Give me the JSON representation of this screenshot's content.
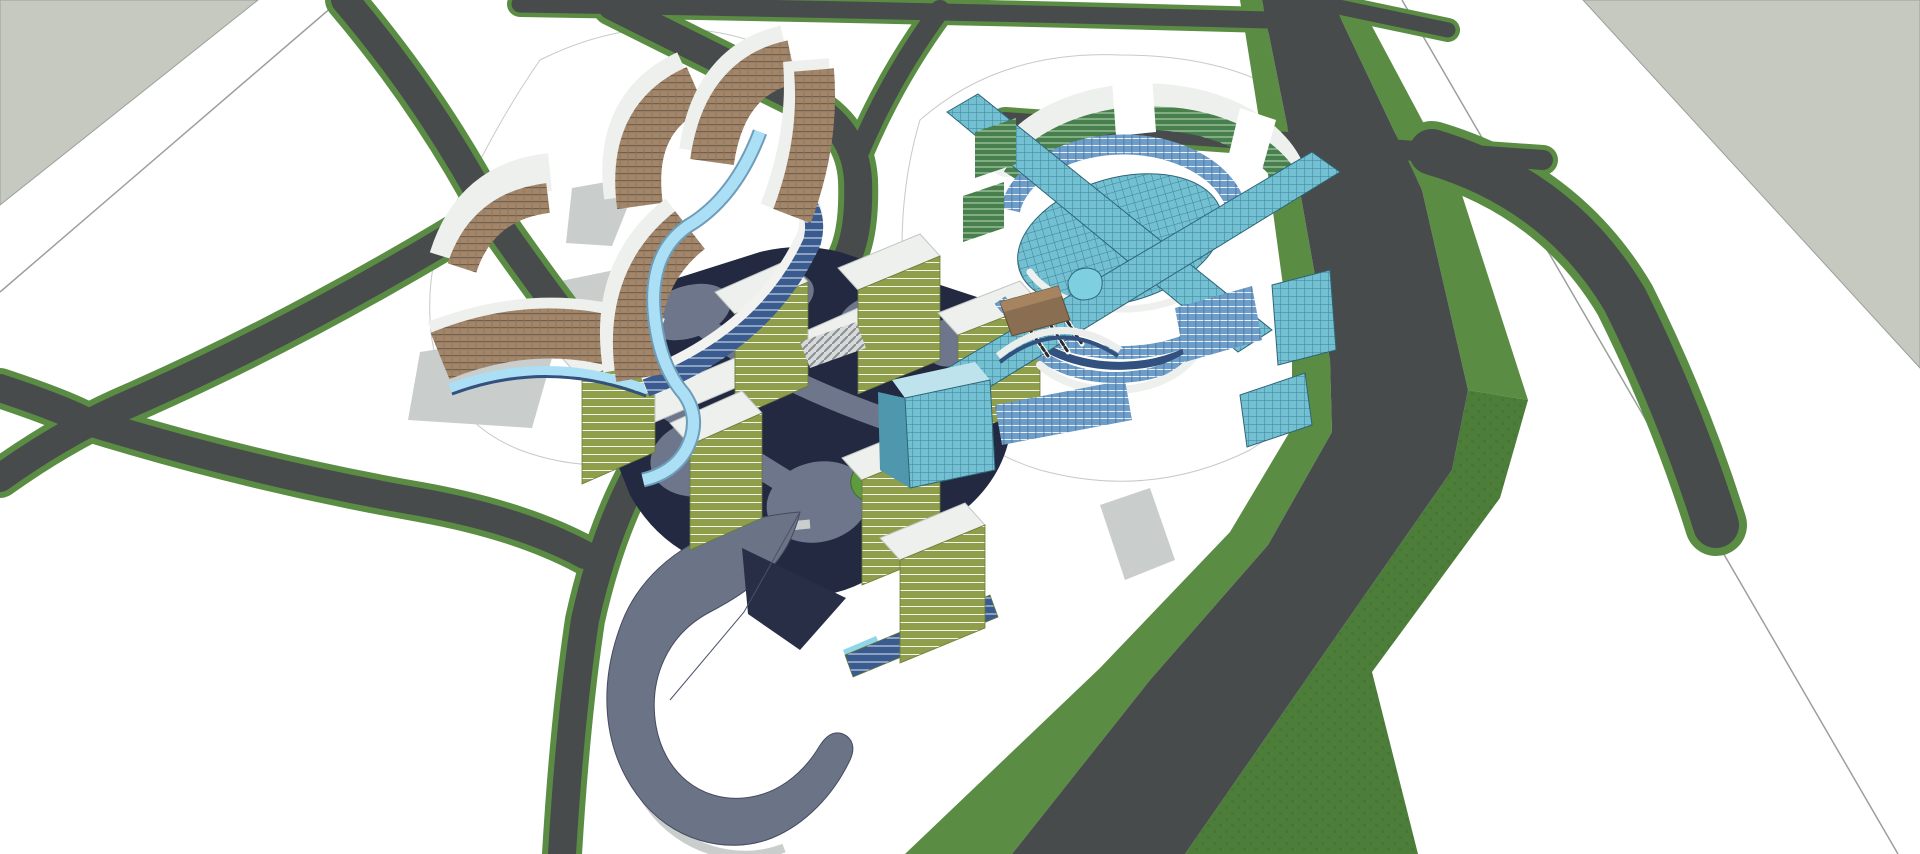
{
  "title": "3D master plan rendering",
  "palette": {
    "ground": "#ffffff",
    "offsite_plane": "#c6c9c0",
    "road_asphalt": "#474b4c",
    "road_verge_green": "#5a8c44",
    "verge_dark_textured": "#4c7d39",
    "boundary_line": "#9aa09b",
    "shadow_gray": "#c9cdcb",
    "plaza_navy": "#222940",
    "plaza_path_gray": "#6e768c",
    "plaza_stub_gray": "#9aa0ad",
    "pond_island_green": "#5e9a3e",
    "pond_rim_white": "#eceeea",
    "pond_water_cyan": "#38c5e8",
    "hotel_facade_brown": "#a3866a",
    "hotel_floorline_brown": "#6f5f4b",
    "roof_white": "#eef0ee",
    "podium_navy": "#3a5b8f",
    "podium_stripe": "#dfe7f2",
    "ribbon_light_blue": "#aadff5",
    "ribbon_edge_blue": "#6f9cb8",
    "glass_dome_teal": "#72c0d2",
    "glass_grid_teal_dark": "#3e8296",
    "glass_green": "#47804d",
    "glass_green_stripe": "#bcd9b9",
    "glass_steel_blue": "#6d9dc9",
    "glass_steel_stripe": "#e8eef5",
    "olive_facade": "#8f9e4b",
    "olive_stripe": "#f2f4ea",
    "ramp_body_gray": "#6b7386",
    "ramp_facet_navy": "#272e45",
    "cyan_base": "#8fd6e8",
    "wood_brown": "#8a6e51",
    "arch_deck_navy": "#32517e",
    "mast_dark": "#2b2b2b"
  },
  "scene": {
    "ground_label": "white site ground plane",
    "offsite_label": "off-site gray plane",
    "roads_label": "road network with green verges",
    "hotel_cluster_label": "curved brown hotel towers with blue ribbon",
    "civic_cluster_label": "teal glass dome complex with radial ramps",
    "residential_cluster_label": "olive slab housing around sunken plaza",
    "plaza_label": "dark plaza with oval pond",
    "ramp_label": "gray teardrop ramp structure"
  }
}
